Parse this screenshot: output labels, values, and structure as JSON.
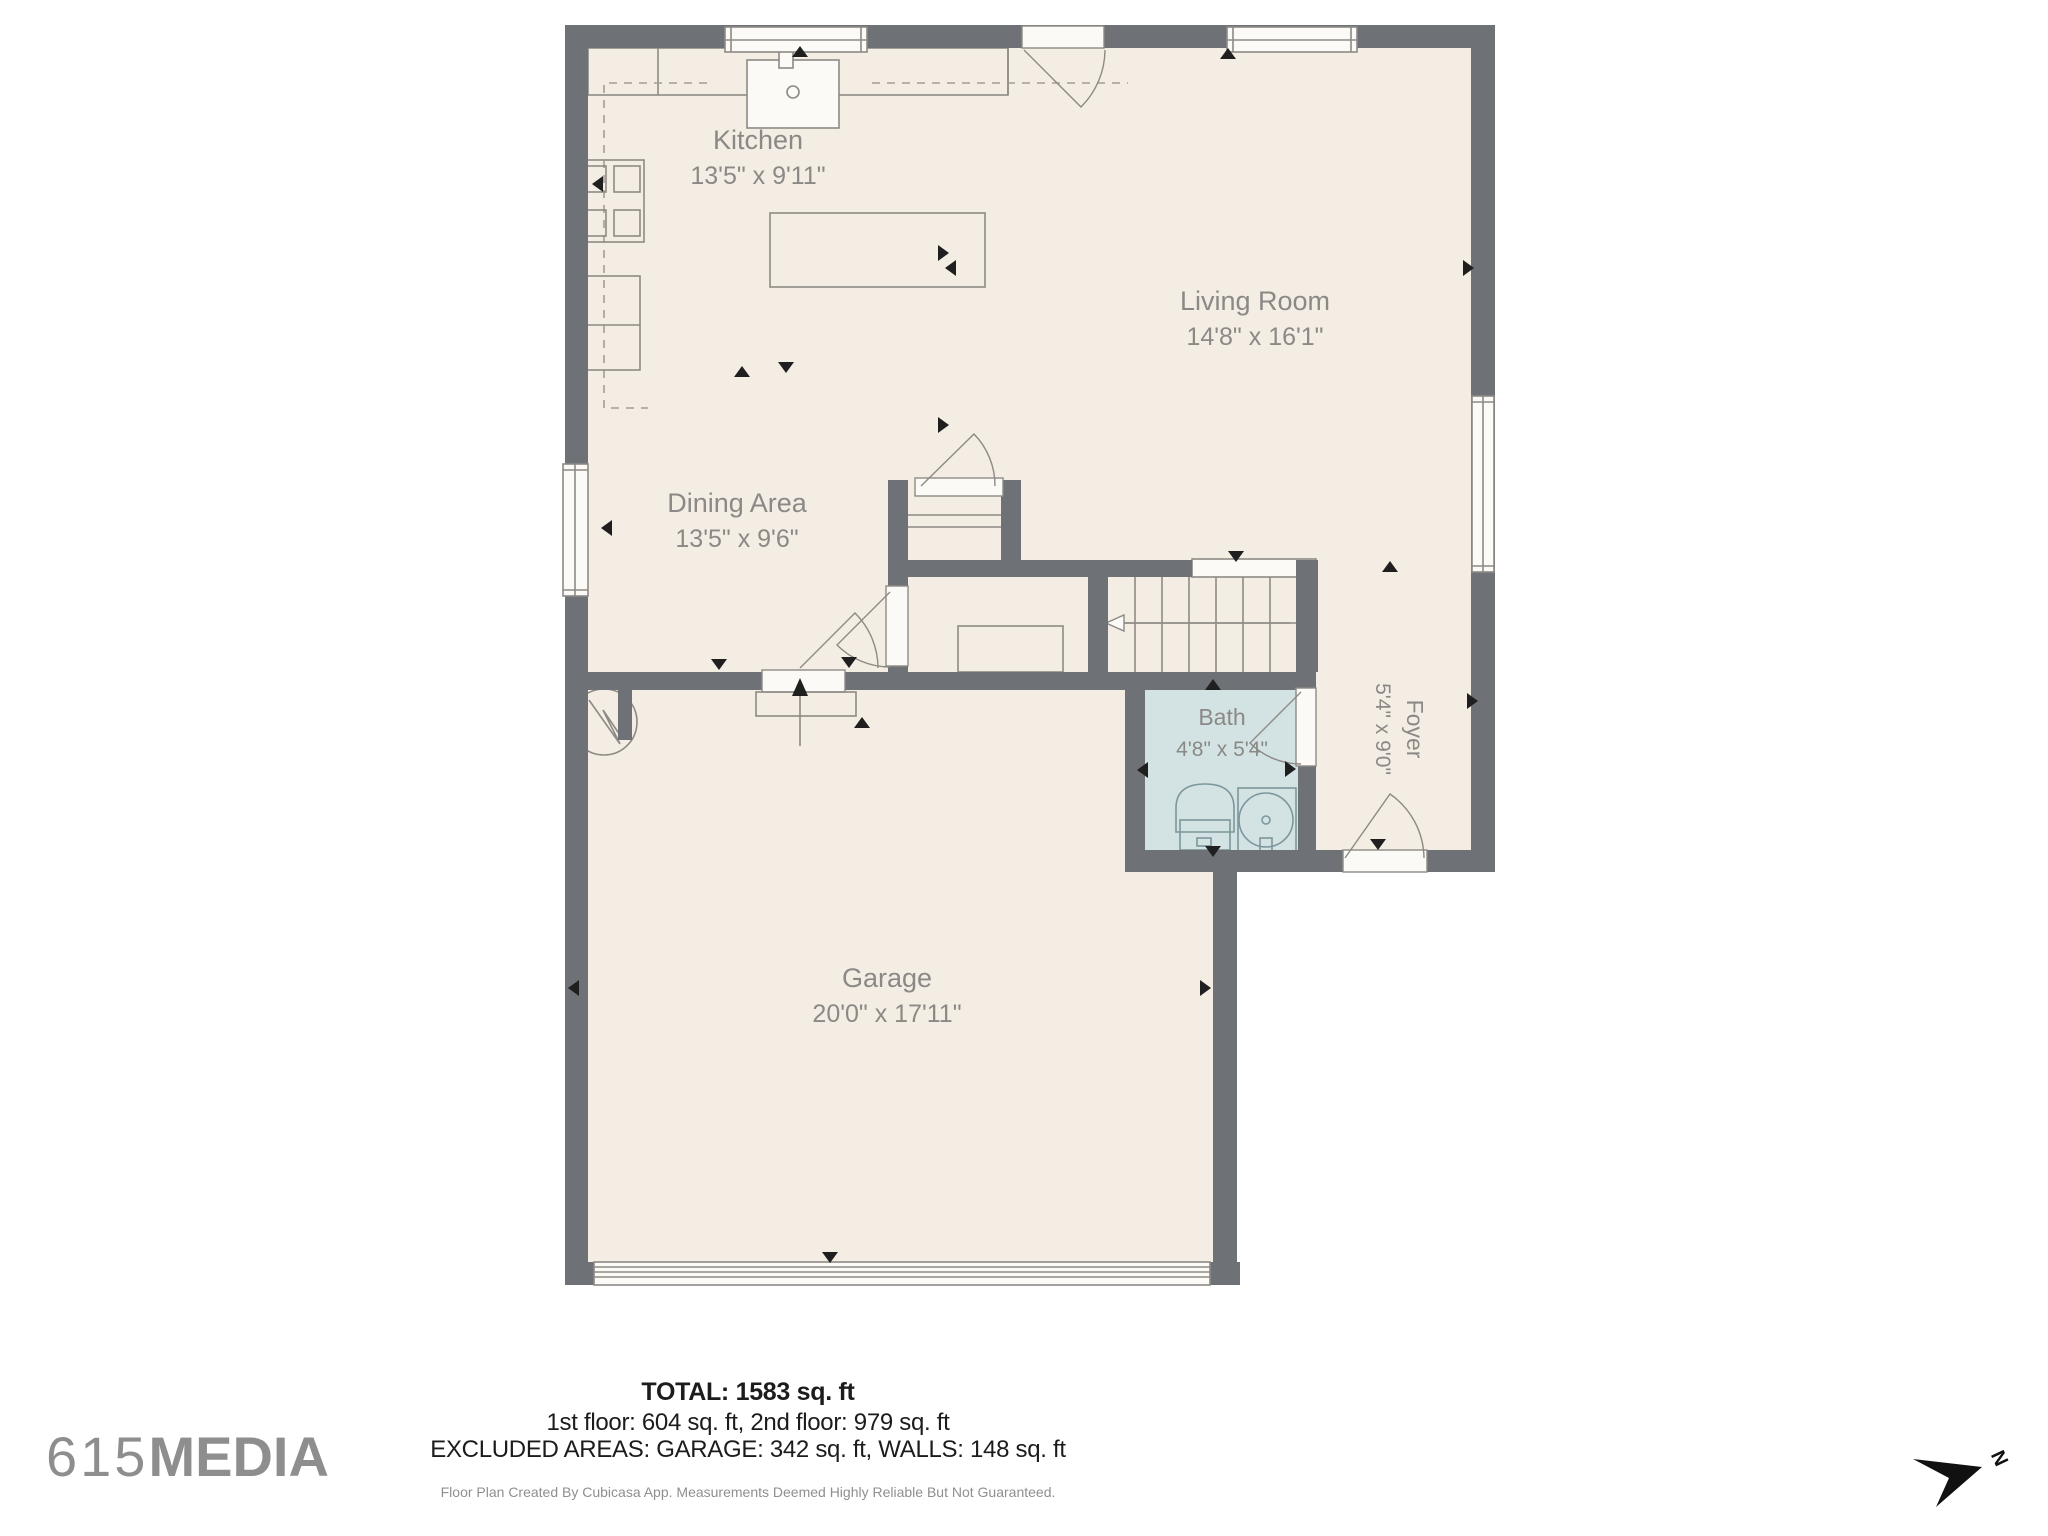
{
  "rooms": {
    "kitchen": {
      "name": "Kitchen",
      "dims": "13'5\" x 9'11\""
    },
    "living_room": {
      "name": "Living Room",
      "dims": "14'8\" x 16'1\""
    },
    "dining_area": {
      "name": "Dining Area",
      "dims": "13'5\" x 9'6\""
    },
    "bath": {
      "name": "Bath",
      "dims": "4'8\" x 5'4\""
    },
    "foyer": {
      "name": "Foyer",
      "dims": "5'4\" x 9'0\""
    },
    "garage": {
      "name": "Garage",
      "dims": "20'0\" x 17'11\""
    }
  },
  "footer": {
    "total": "TOTAL: 1583 sq. ft",
    "floors": "1st floor: 604 sq. ft, 2nd floor: 979 sq. ft",
    "excluded": "EXCLUDED AREAS: GARAGE: 342 sq. ft, WALLS: 148 sq. ft",
    "disclaimer": "Floor Plan Created By Cubicasa App. Measurements Deemed Highly Reliable But Not Guaranteed."
  },
  "branding": {
    "logo_prefix": "615",
    "logo_suffix": "MEDIA"
  },
  "compass": {
    "label": "N"
  },
  "colors": {
    "wall": "#6e7276",
    "floor": "#f4ede4",
    "bath_floor": "#d3e3e4",
    "fixture_line": "#8d8a86",
    "bath_fixture_line": "#7d969c",
    "room_label": "#8b8986",
    "footer_text": "#1c1c1c",
    "muted_text": "#8f8f8f",
    "logo": "#8e8e8e",
    "marker": "#1f1f1f"
  }
}
